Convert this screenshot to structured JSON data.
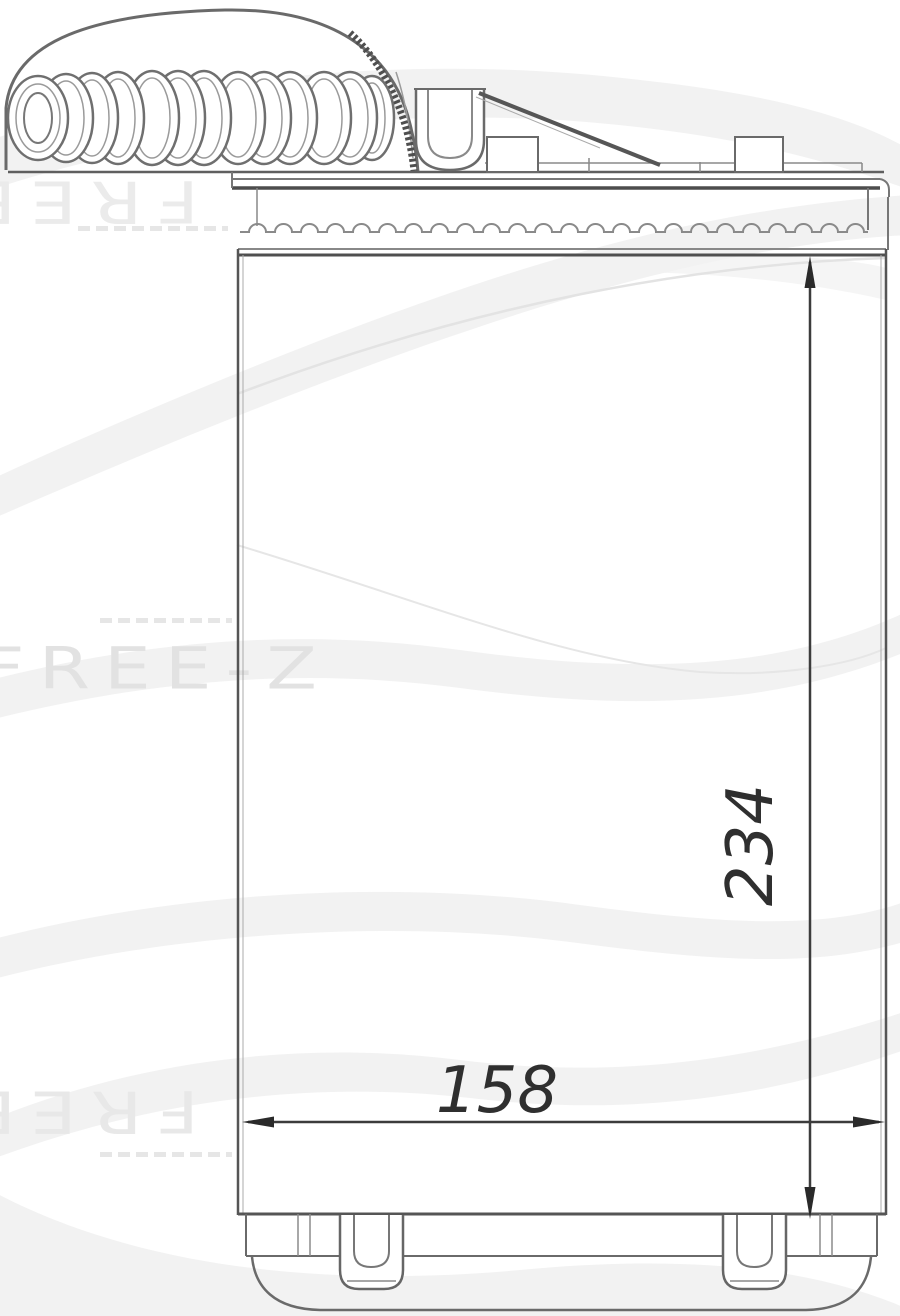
{
  "canvas": {
    "width": 900,
    "height": 1316,
    "background": "#ffffff"
  },
  "watermark": {
    "brand": "FREE-Z",
    "color_light": "#ebebeb",
    "color_mid": "#e2e2e2"
  },
  "dimensions": {
    "height_label": "234",
    "width_label": "158",
    "text_color": "#2f2f2f",
    "line_color": "#3c3c3c"
  },
  "drawing": {
    "line_color": "#6a6a6a",
    "dark_line_color": "#4f4f4f",
    "light_line_color": "#9a9a9a",
    "wave_color": "#f0f0f0",
    "wave_edge_color": "#e3e3e3",
    "fill_color": "#ffffff"
  }
}
